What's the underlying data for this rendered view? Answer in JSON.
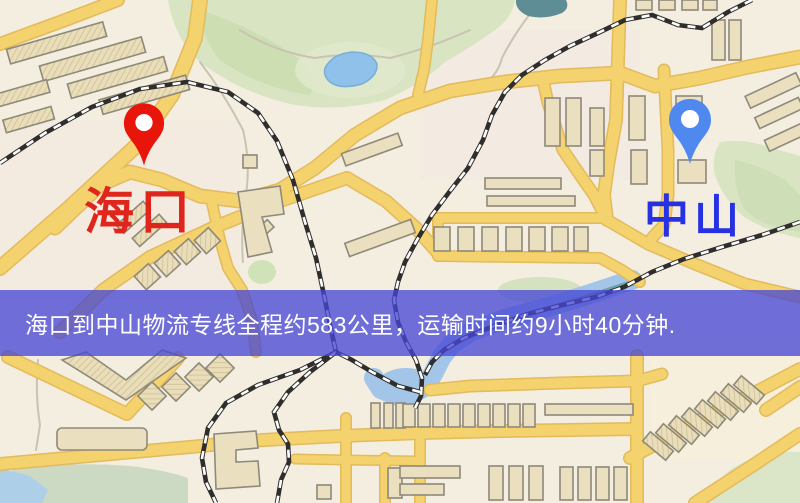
{
  "banner": {
    "text": "海口到中山物流专线全程约583公里，运输时间约9小时40分钟.",
    "background": "#4646d4c4",
    "text_color": "#ffffff"
  },
  "markers": {
    "origin": {
      "label": "海口",
      "pin_icon": "map-pin",
      "pin_color": "#e8150a",
      "label_color": "#e0251c"
    },
    "destination": {
      "label": "中山",
      "pin_icon": "map-pin",
      "pin_color": "#4f88ee",
      "label_color": "#2531e2"
    }
  },
  "map_palette": {
    "background": "#f4eee1",
    "road": "#f4d26e",
    "road_casing": "#e3ba5c",
    "building_fill": "#eae0c0",
    "building_outline": "#8f897a",
    "park": "#d8e4c2",
    "water": "#a3c6e8",
    "pond": "#5f8d96",
    "railway": "#2f2e2c"
  }
}
